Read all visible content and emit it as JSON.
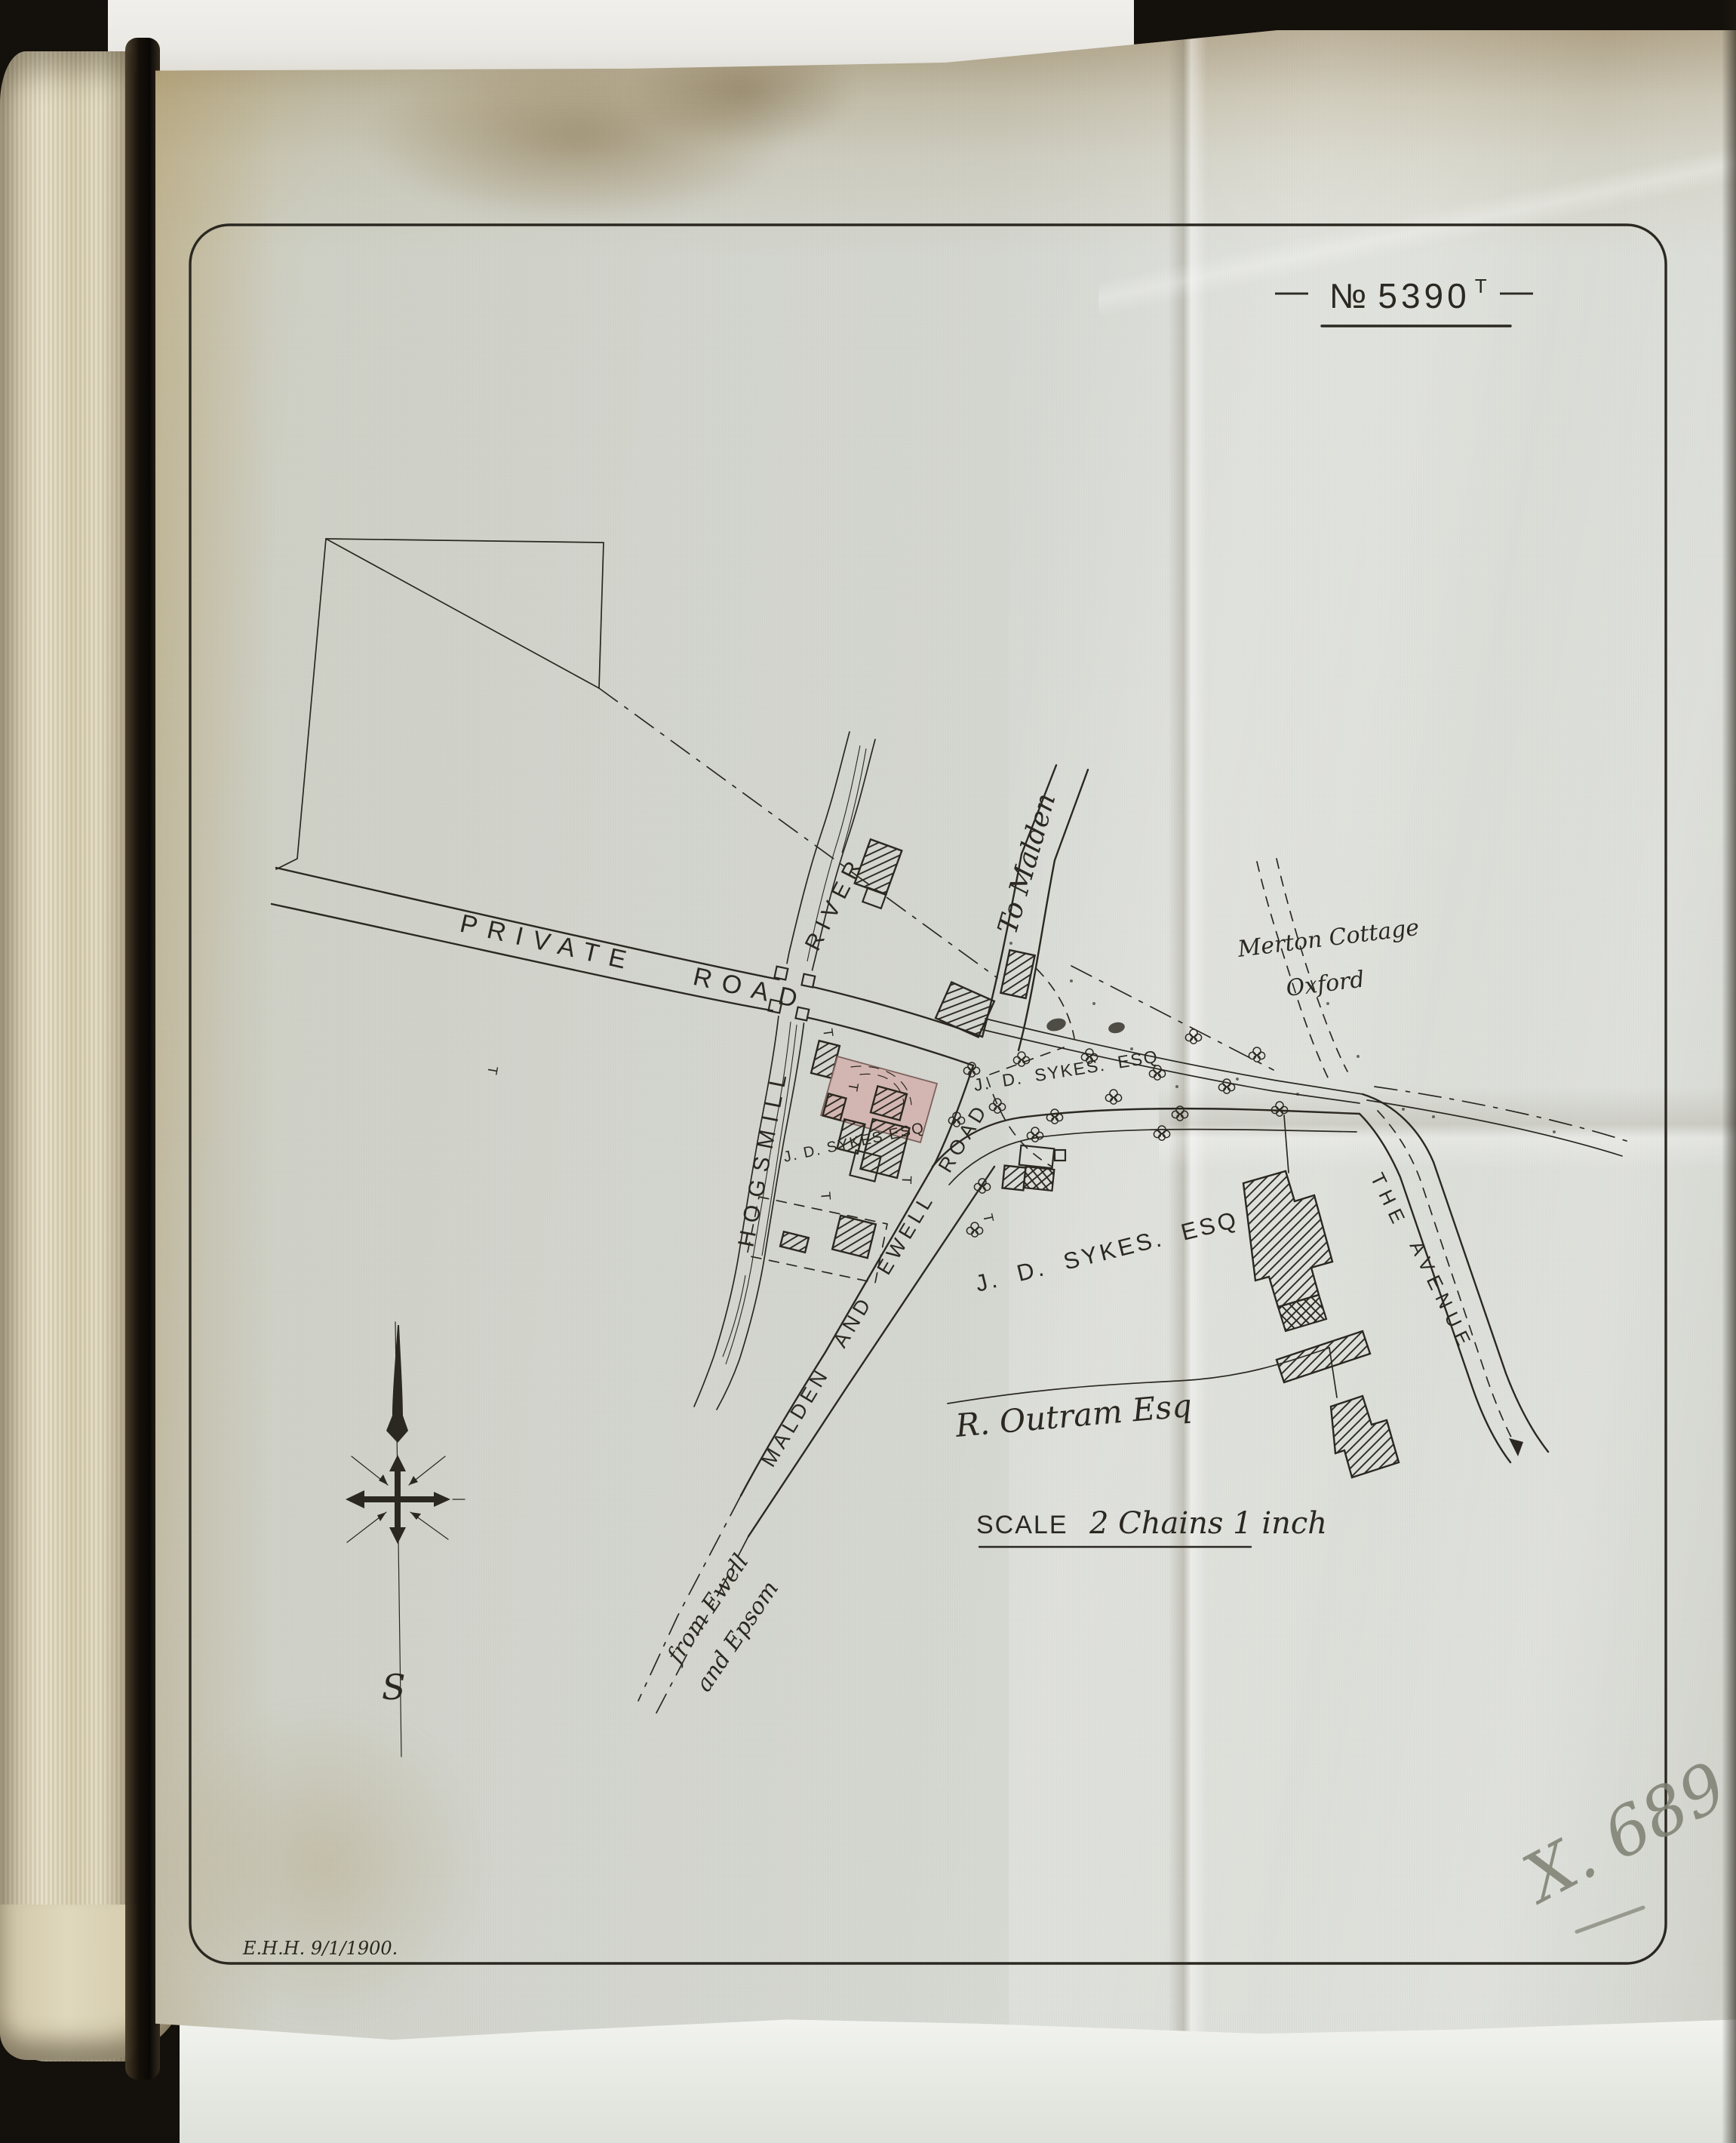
{
  "sheet": {
    "plan_number_numero": "№",
    "plan_number": "5390",
    "plan_number_suffix": "T",
    "flank_dash": "—",
    "surveyor_mark": "E.H.H. 9/1/1900.",
    "pencil_annotation": "X. 689",
    "scale_word": "SCALE",
    "scale_text": "2 Chains 1 inch"
  },
  "labels": {
    "private_road": "PRIVATE ROAD",
    "hogsmill": "HOGSMILL",
    "river": "RIVER",
    "to_malden": "To Malden",
    "merton_cottage": "Merton Cottage",
    "merton_cottage_2": "Oxford",
    "owner_orchard": "J. D. SYKES. ESQ",
    "owner_house": "J. D. SYKES ESQ",
    "owner_field": "J. D. SYKES. ESQ",
    "owner_south_field": "R. Outram Esq",
    "malden_ewell_road": "MALDEN AND EWELL ROAD",
    "avenue_word1": "THE",
    "avenue_word2": "AVENUE",
    "from_ewell": "from Ewell",
    "and_epsom": "and Epsom",
    "compass_south": "S",
    "gate_mark": "T"
  },
  "colors": {
    "ink": "#2a2820",
    "sheet_base": "#d2d4cd",
    "stain_tan": "#ad8c55",
    "building_pink": "#d2aeaa",
    "page_cream": "#dcd3b6",
    "backing_white": "#ebeae5",
    "pencil_gray": "#7e7f72"
  }
}
